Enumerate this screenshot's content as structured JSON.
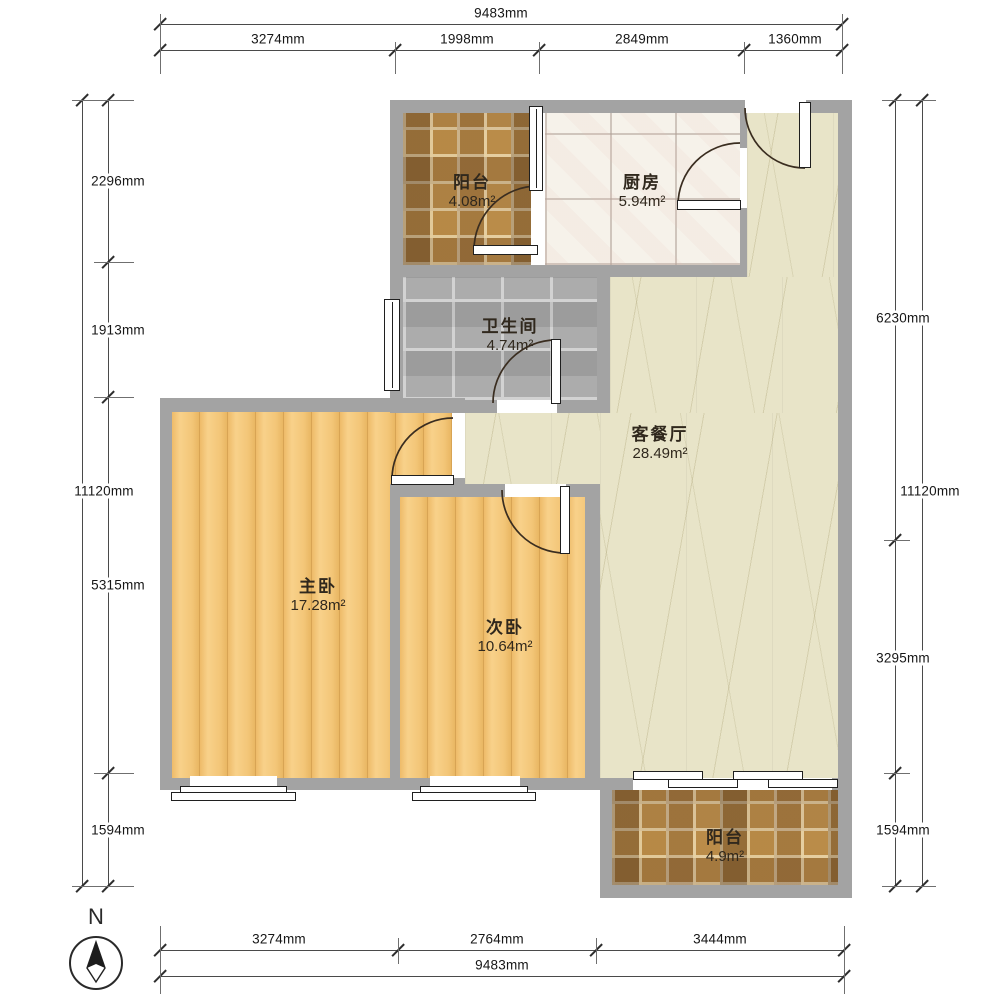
{
  "compass": {
    "north_label": "N"
  },
  "rooms": {
    "balcony_top": {
      "name": "阳台",
      "area": "4.08m²"
    },
    "kitchen": {
      "name": "厨房",
      "area": "5.94m²"
    },
    "bathroom": {
      "name": "卫生间",
      "area": "4.74m²"
    },
    "living": {
      "name": "客餐厅",
      "area": "28.49m²"
    },
    "master_bedroom": {
      "name": "主卧",
      "area": "17.28m²"
    },
    "second_bedroom": {
      "name": "次卧",
      "area": "10.64m²"
    },
    "balcony_bottom": {
      "name": "阳台",
      "area": "4.9m²"
    }
  },
  "dimensions": {
    "top": {
      "total": "9483mm",
      "segments": [
        "3274mm",
        "1998mm",
        "2849mm",
        "1360mm"
      ]
    },
    "bottom": {
      "total": "9483mm",
      "segments": [
        "3274mm",
        "2764mm",
        "3444mm"
      ]
    },
    "left": {
      "total": "11120mm",
      "segments": [
        "2296mm",
        "1913mm",
        "5315mm",
        "1594mm"
      ]
    },
    "right": {
      "total": "11120mm",
      "segments": [
        "6230mm",
        "3295mm",
        "1594mm"
      ]
    }
  },
  "colors": {
    "wall": "#a3a3a3",
    "bedroom_floor": "#f2c67c",
    "living_floor": "#e8e4c8",
    "bathroom_floor": "#a6a6a6",
    "kitchen_floor": "#f6f2ea",
    "balcony_floor": "#c7a266",
    "dimension_text": "#161616"
  }
}
